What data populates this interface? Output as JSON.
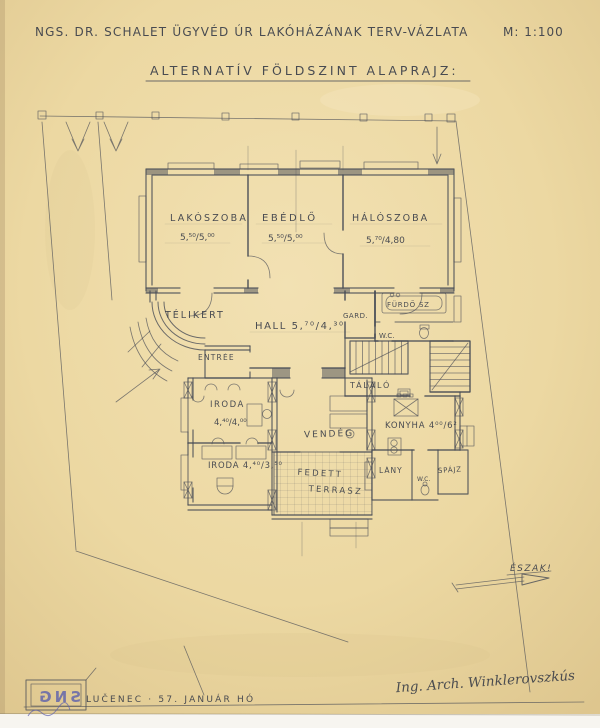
{
  "title": {
    "line1": "NGS. DR. SCHALET ÜGYVÉD ÚR LAKÓHÁZÁNAK TERV-VÁZLATA",
    "scale": "M: 1:100",
    "line2": "ALTERNATÍV FÖLDSZINT ALAPRAJZ:"
  },
  "plan": {
    "rooms": [
      {
        "name": "LAKÓSZOBA",
        "dims": "5,⁵⁰/5,⁰⁰"
      },
      {
        "name": "EBÉDLŐ",
        "dims": "5,⁵⁰/5,⁰⁰"
      },
      {
        "name": "HÁLÓSZOBA",
        "dims": "5,⁷⁰/4,80"
      },
      {
        "name": "TÉLIKERT"
      },
      {
        "name": "HALL 5,⁷⁰/4,³⁰"
      },
      {
        "name": "ENTRÉE"
      },
      {
        "name": "GARD."
      },
      {
        "name": "FÜRDŐ SZ"
      },
      {
        "name": "W.C."
      },
      {
        "name": "TÁLALÓ"
      },
      {
        "name": "IRODA",
        "dims": "4,⁴⁰/4,⁰⁰"
      },
      {
        "name": "IRODA 4,⁴⁰/3,⁵⁰"
      },
      {
        "name": "VENDÉG"
      },
      {
        "name": "FEDETT",
        "name2": "TERRASZ"
      },
      {
        "name": "KONYHA 4⁰⁰/6²"
      },
      {
        "name": "LÁNY"
      },
      {
        "name": "W.C."
      },
      {
        "name": "SPÁJZ"
      }
    ],
    "compass": {
      "label": "ÉSZAK!"
    }
  },
  "footer": {
    "place_date": "LUČENEC · 57. JANUÁR HÓ",
    "signature": "Ing. Arch. Winklerovszkús",
    "stamp": "SNG"
  },
  "colors": {
    "paper": "#eedaa7",
    "pencil": "#484c56",
    "stamp_blue": "#5c60ad"
  }
}
